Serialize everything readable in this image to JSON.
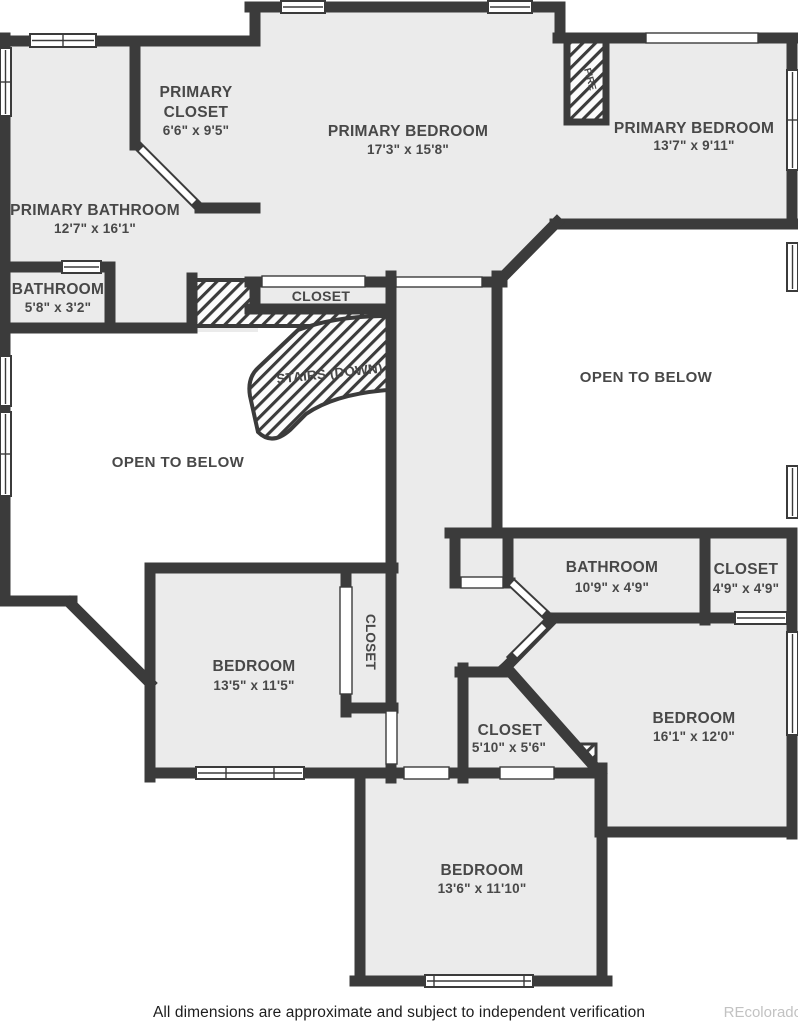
{
  "rooms": {
    "primary_closet": {
      "line1": "PRIMARY",
      "line2": "CLOSET",
      "dims": "6'6\" x 9'5\""
    },
    "primary_bedroom_a": {
      "name": "PRIMARY BEDROOM",
      "dims": "17'3\" x 15'8\""
    },
    "primary_bedroom_b": {
      "name": "PRIMARY BEDROOM",
      "dims": "13'7\" x 9'11\""
    },
    "primary_bathroom": {
      "name": "PRIMARY BATHROOM",
      "dims": "12'7\" x 16'1\""
    },
    "bathroom_small": {
      "name": "BATHROOM",
      "dims": "5'8\" x 3'2\""
    },
    "closet_top": {
      "name": "CLOSET"
    },
    "stairs": {
      "name": "STAIRS (DOWN)"
    },
    "open_left": {
      "name": "OPEN TO BELOW"
    },
    "open_right": {
      "name": "OPEN TO BELOW"
    },
    "bathroom_mid": {
      "name": "BATHROOM",
      "dims": "10'9\" x 4'9\""
    },
    "closet_mid": {
      "name": "CLOSET",
      "dims": "4'9\" x 4'9\""
    },
    "bedroom_left": {
      "name": "BEDROOM",
      "dims": "13'5\" x 11'5\""
    },
    "closet_vertical": {
      "name": "CLOSET"
    },
    "closet_lower": {
      "name": "CLOSET",
      "dims": "5'10\" x 5'6\""
    },
    "bedroom_right": {
      "name": "BEDROOM",
      "dims": "16'1\" x 12'0\""
    },
    "bedroom_bottom": {
      "name": "BEDROOM",
      "dims": "13'6\" x 11'10\""
    },
    "fireplace": {
      "name": "FIRE"
    }
  },
  "footer": {
    "disclaimer": "All dimensions are approximate and subject to independent verification",
    "watermark": "REcolorado"
  },
  "colors": {
    "wall": "#3b3b3b",
    "room_fill": "#ebebeb",
    "background": "#ffffff",
    "label_text": "#484848"
  }
}
